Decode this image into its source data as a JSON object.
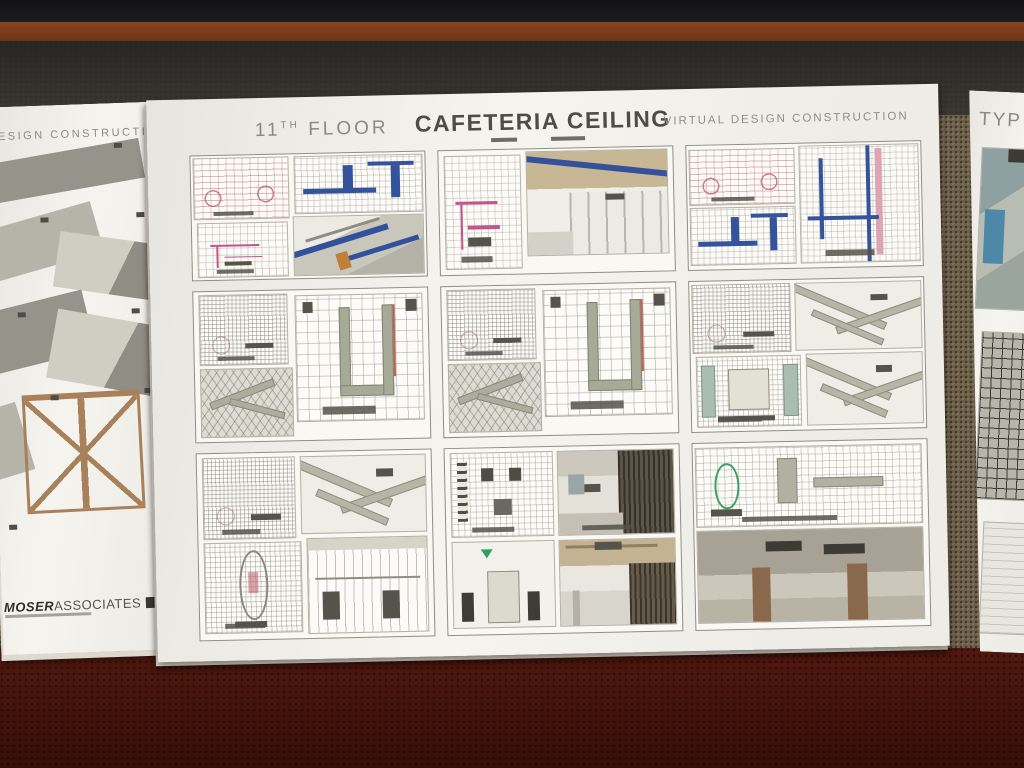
{
  "environment": {
    "shelf_color": "#151318",
    "wood_strip_color": "#7c3b20",
    "table_shade_color": "#3f3d3a",
    "tweed_color": "#6b5e49",
    "carpet_color": "#4b150c",
    "paper_color": "#f4f2ed"
  },
  "left_document": {
    "header_partial": "DESIGN  CONSTRUCTION",
    "logo_bold": "MOSER",
    "logo_regular": "ASSOCIATES",
    "shapes": [
      {
        "t": "slab-dark",
        "x": 6,
        "y": 46,
        "w": 150,
        "h": 40,
        "r": -8
      },
      {
        "t": "slab-med",
        "x": -10,
        "y": 111,
        "w": 120,
        "h": 52,
        "r": -14
      },
      {
        "t": "angle",
        "x": 66,
        "y": 136,
        "w": 120,
        "h": 56,
        "r": 10
      },
      {
        "t": "slab-dark",
        "x": -12,
        "y": 196,
        "w": 110,
        "h": 62,
        "r": -12
      },
      {
        "t": "angle",
        "x": 58,
        "y": 216,
        "w": 128,
        "h": 70,
        "r": 12
      },
      {
        "t": "slab-med",
        "x": -16,
        "y": 300,
        "w": 46,
        "h": 70,
        "r": -15
      },
      {
        "t": "scaffold",
        "x": 28,
        "y": 288,
        "w": 112,
        "h": 110,
        "r": -1
      },
      {
        "t": "chip",
        "x": 128,
        "y": 40,
        "w": 8,
        "h": 5,
        "r": 0
      },
      {
        "t": "chip",
        "x": 52,
        "y": 112,
        "w": 8,
        "h": 5,
        "r": 0
      },
      {
        "t": "chip",
        "x": 148,
        "y": 110,
        "w": 8,
        "h": 5,
        "r": 0
      },
      {
        "t": "chip",
        "x": 26,
        "y": 206,
        "w": 8,
        "h": 5,
        "r": 0
      },
      {
        "t": "chip",
        "x": 140,
        "y": 206,
        "w": 8,
        "h": 5,
        "r": 0
      },
      {
        "t": "chip",
        "x": 56,
        "y": 290,
        "w": 8,
        "h": 5,
        "r": 0
      },
      {
        "t": "chip",
        "x": 150,
        "y": 286,
        "w": 8,
        "h": 5,
        "r": 0
      },
      {
        "t": "chip",
        "x": 10,
        "y": 418,
        "w": 8,
        "h": 5,
        "r": 0
      }
    ]
  },
  "main_sheet": {
    "floor_number": "11",
    "floor_ordinal": "TH",
    "floor_word": " FLOOR",
    "title": "CAFETERIA CEILING",
    "subtitle": "VIRTUAL DESIGN CONSTRUCTION",
    "accent_colors": {
      "duct_blue": "#35539c",
      "plan_red": "#b05c68",
      "plan_magenta": "#c2558a",
      "pink_strip": "#dda4b6",
      "orange_column": "#c07f3c",
      "duct_green_gray": "#a6ab97",
      "ceiling_tan": "#c7b795",
      "column_brown": "#8a684b",
      "marker_green": "#2f9e62"
    },
    "groups": [
      {
        "name": "cafeteria-ceiling-plans-with-blue-ducts",
        "minis": [
          {
            "v": "plan-red",
            "x": 1,
            "y": 2,
            "w": 41,
            "h": 50,
            "cap": true
          },
          {
            "v": "plan-blue",
            "x": 44,
            "y": 2,
            "w": 55,
            "h": 46
          },
          {
            "v": "plan-magenta",
            "x": 2,
            "y": 54,
            "w": 39,
            "h": 44,
            "cap": true
          },
          {
            "v": "iso-blue",
            "x": 43,
            "y": 50,
            "w": 56,
            "h": 48
          }
        ]
      },
      {
        "name": "plan-and-interior-perspective",
        "minis": [
          {
            "v": "plan-magenta",
            "x": 2,
            "y": 4,
            "w": 33,
            "h": 92,
            "cap": true
          },
          {
            "v": "perspective",
            "x": 37,
            "y": 2,
            "w": 61,
            "h": 84
          }
        ]
      },
      {
        "name": "ceiling-plan-and-piping-plan",
        "minis": [
          {
            "v": "plan-red",
            "x": 1,
            "y": 3,
            "w": 45,
            "h": 45,
            "cap": true
          },
          {
            "v": "plan-blue",
            "x": 1,
            "y": 50,
            "w": 45,
            "h": 47
          },
          {
            "v": "plan-bluepink",
            "x": 48,
            "y": 2,
            "w": 51,
            "h": 95,
            "cap": true
          }
        ]
      },
      {
        "name": "ceiling-grid-ductwork-study-a",
        "minis": [
          {
            "v": "plan-dense",
            "x": 2,
            "y": 2,
            "w": 38,
            "h": 47,
            "cap": true
          },
          {
            "v": "axon-grid",
            "x": 2,
            "y": 51,
            "w": 40,
            "h": 46
          },
          {
            "v": "grid-duct",
            "x": 43,
            "y": 3,
            "w": 55,
            "h": 85,
            "cap": true
          }
        ]
      },
      {
        "name": "ceiling-grid-ductwork-study-b",
        "minis": [
          {
            "v": "plan-dense",
            "x": 2,
            "y": 2,
            "w": 38,
            "h": 47,
            "cap": true
          },
          {
            "v": "axon-grid",
            "x": 2,
            "y": 51,
            "w": 40,
            "h": 46
          },
          {
            "v": "grid-duct",
            "x": 43,
            "y": 3,
            "w": 55,
            "h": 85,
            "cap": true
          }
        ]
      },
      {
        "name": "ceiling-plan-and-axon-ducts",
        "minis": [
          {
            "v": "plan-dense",
            "x": 1,
            "y": 2,
            "w": 42,
            "h": 46,
            "cap": true
          },
          {
            "v": "axon-duct",
            "x": 45,
            "y": 2,
            "w": 54,
            "h": 45
          },
          {
            "v": "plan-detail",
            "x": 2,
            "y": 50,
            "w": 45,
            "h": 47,
            "cap": true
          },
          {
            "v": "axon-duct",
            "x": 49,
            "y": 49,
            "w": 50,
            "h": 48
          }
        ]
      },
      {
        "name": "plan-axon-and-elevation",
        "minis": [
          {
            "v": "plan-dense",
            "x": 2,
            "y": 2,
            "w": 40,
            "h": 44,
            "cap": true
          },
          {
            "v": "axon-duct",
            "x": 44,
            "y": 2,
            "w": 54,
            "h": 42
          },
          {
            "v": "plan-oval",
            "x": 2,
            "y": 48,
            "w": 42,
            "h": 49,
            "cap": true
          },
          {
            "v": "elevation",
            "x": 46,
            "y": 46,
            "w": 52,
            "h": 52
          }
        ]
      },
      {
        "name": "furniture-plan-and-interior-renders",
        "minis": [
          {
            "v": "plan-furniture",
            "x": 2,
            "y": 2,
            "w": 44,
            "h": 46,
            "cap": true
          },
          {
            "v": "elev-green",
            "x": 2,
            "y": 50,
            "w": 44,
            "h": 47
          },
          {
            "v": "render-dark",
            "x": 48,
            "y": 2,
            "w": 50,
            "h": 46,
            "cap": true
          },
          {
            "v": "render-ceiling",
            "x": 48,
            "y": 50,
            "w": 50,
            "h": 47
          }
        ]
      },
      {
        "name": "wide-ceiling-plan-and-plenum-view",
        "minis": [
          {
            "v": "plan-circle",
            "x": 1,
            "y": 2,
            "w": 97,
            "h": 43,
            "cap": true
          },
          {
            "v": "plenum",
            "x": 1,
            "y": 47,
            "w": 97,
            "h": 50
          }
        ]
      }
    ]
  },
  "right_document": {
    "header_partial": "TYP"
  }
}
